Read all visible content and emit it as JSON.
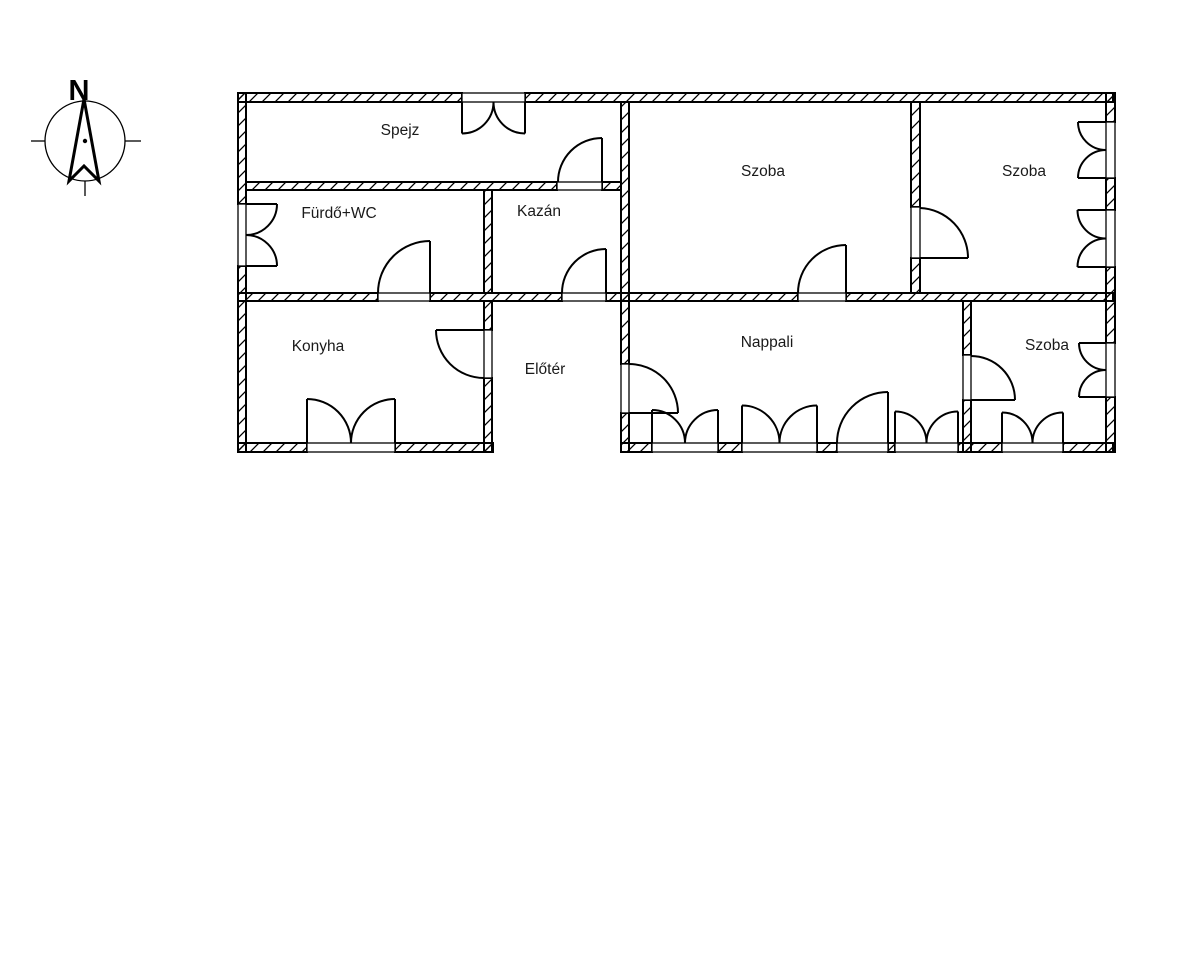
{
  "compass": {
    "north_label": "N"
  },
  "rooms": {
    "spejz": {
      "label": "Spejz"
    },
    "furdo_wc": {
      "label": "Fürdő+WC"
    },
    "kazan": {
      "label": "Kazán"
    },
    "szoba_top_middle": {
      "label": "Szoba"
    },
    "szoba_top_right": {
      "label": "Szoba"
    },
    "konyha": {
      "label": "Konyha"
    },
    "eloter": {
      "label": "Előtér"
    },
    "nappali": {
      "label": "Nappali"
    },
    "szoba_bottom_right": {
      "label": "Szoba"
    }
  },
  "colors": {
    "line": "#000000",
    "text": "#1a1a1a",
    "background": "#ffffff"
  }
}
